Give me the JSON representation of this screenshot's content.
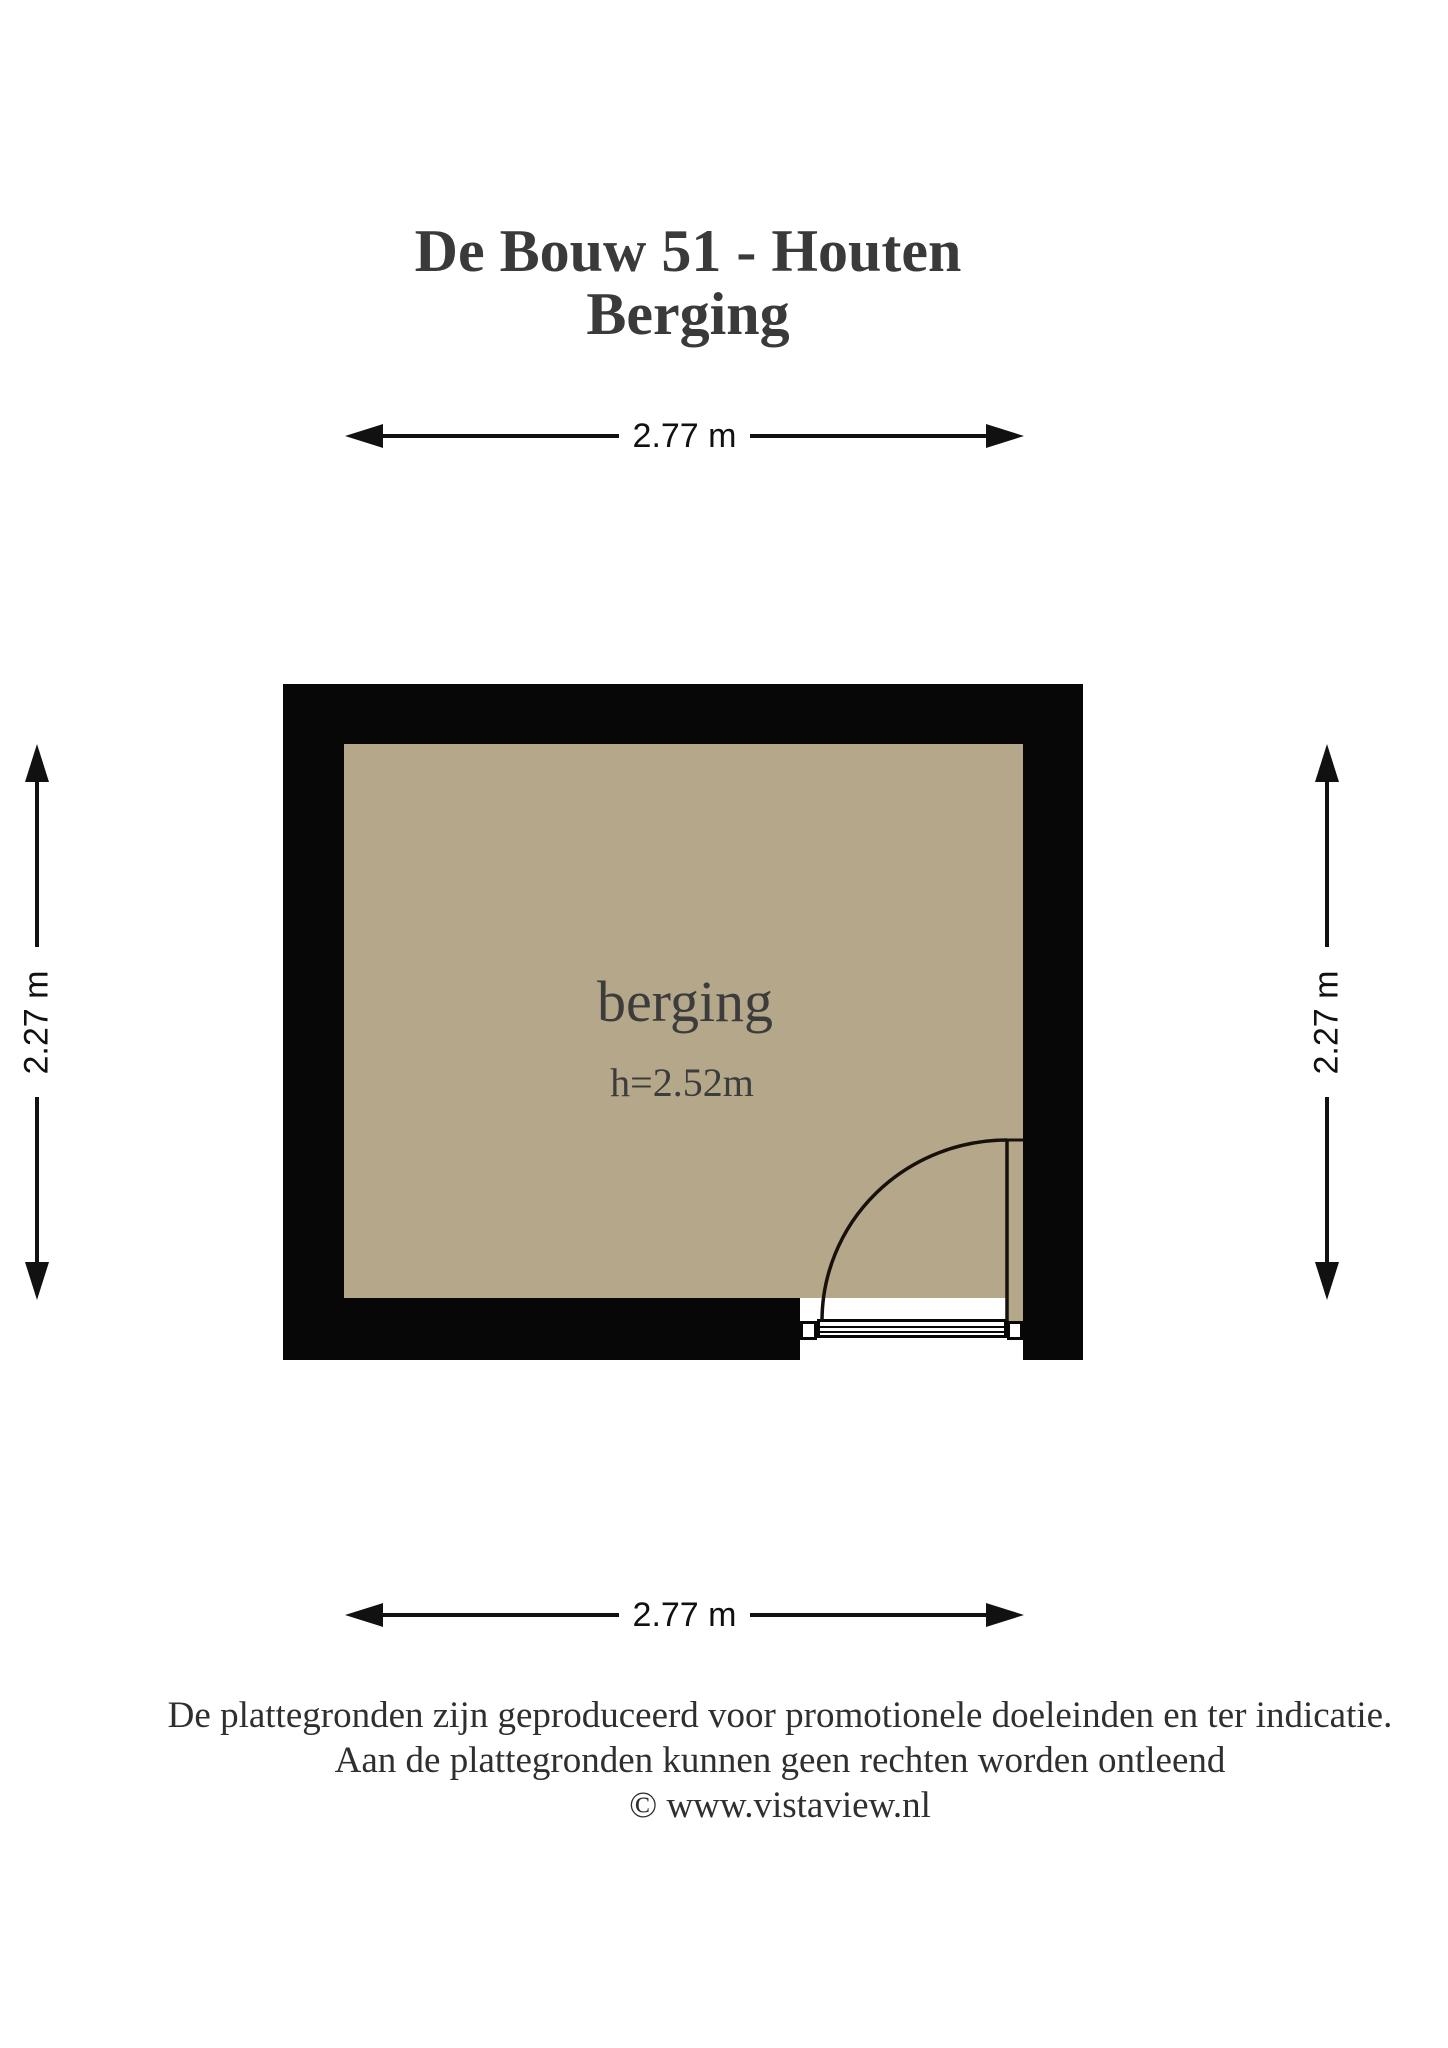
{
  "title": {
    "line1": "De Bouw 51 - Houten",
    "line2": "Berging"
  },
  "plan": {
    "room_label": "berging",
    "ceiling_height_label": "h=2.52m",
    "dimensions": {
      "width_top": "2.77 m",
      "width_bottom": "2.77 m",
      "height_left": "2.27 m",
      "height_right": "2.27 m"
    }
  },
  "footer": {
    "line1": "De plattegronden zijn geproduceerd voor promotionele doeleinden en ter indicatie.",
    "line2": "Aan de plattegronden kunnen geen rechten worden ontleend",
    "line3": "© www.vistaview.nl"
  },
  "colors": {
    "background": "#ffffff",
    "wall": "#070707",
    "floor": "#b5a88a",
    "title_text": "#3a3a3a",
    "room_text": "#3c3c3c",
    "footer_text": "#2f2f2f",
    "dim_text": "#111111",
    "dim_line": "#111111",
    "door_stroke": "#18100a"
  }
}
